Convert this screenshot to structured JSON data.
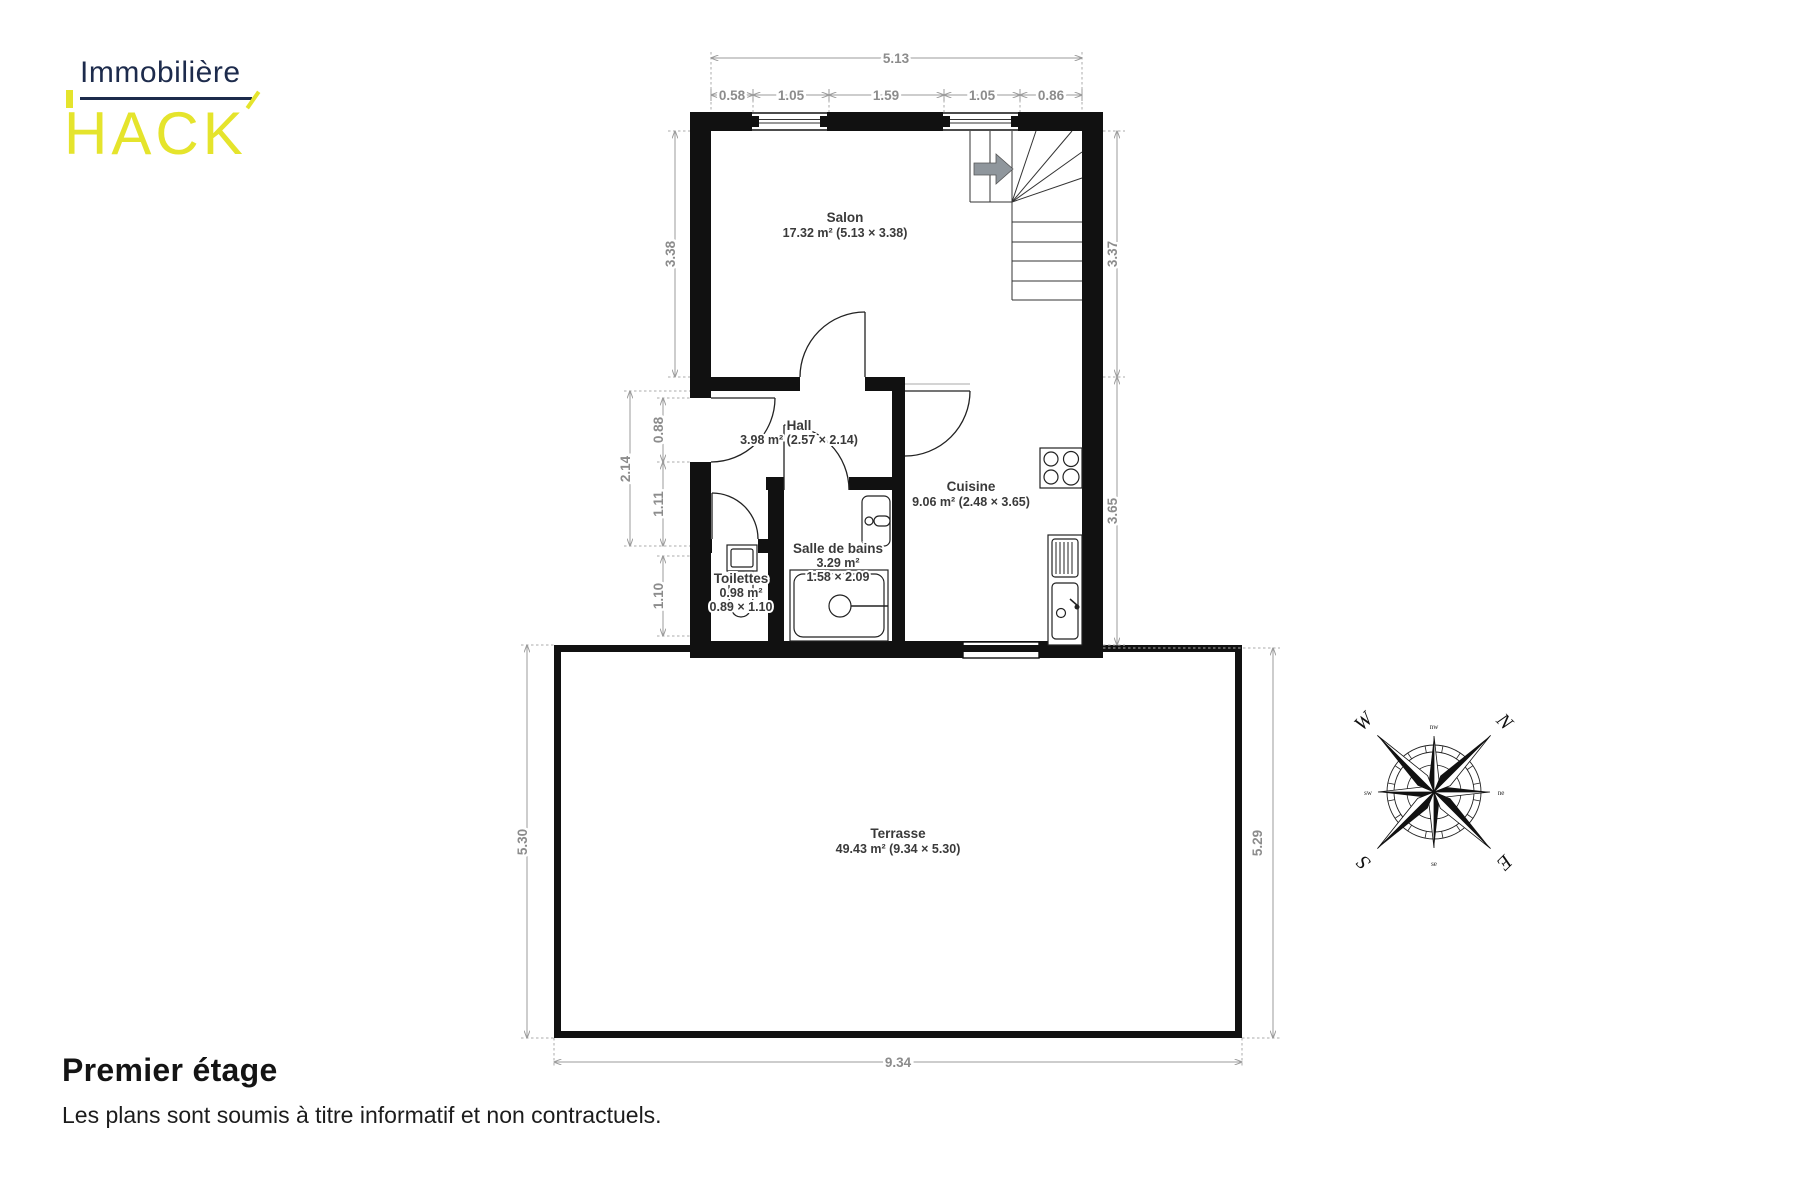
{
  "logo": {
    "line1": "Immobilière",
    "letters": [
      "H",
      "A",
      "C",
      "K"
    ],
    "navy": "#1d2b4c",
    "yellow": "#e5e42c"
  },
  "plan": {
    "rooms": [
      {
        "name": "Salon",
        "line2": "17.32 m² (5.13 × 3.38)"
      },
      {
        "name": "Hall",
        "line2": "3.98 m² (2.57 × 2.14)"
      },
      {
        "name": "Cuisine",
        "line2": "9.06 m² (2.48 × 3.65)"
      },
      {
        "name": "Salle de bains",
        "line2": "3.29 m²",
        "line3": "1.58 × 2.09"
      },
      {
        "name": "Toilettes",
        "line2": "0.98 m²",
        "line3": "0.89 × 1.10"
      },
      {
        "name": "Terrasse",
        "line2": "49.43 m² (9.34 × 5.30)"
      }
    ],
    "dims": {
      "top_total": "5.13",
      "top_segments": [
        "0.58",
        "1.05",
        "1.59",
        "1.05",
        "0.86"
      ],
      "salon_height": "3.38",
      "hall_height": "2.14",
      "hall_upper": "0.88",
      "hall_lower": "1.11",
      "toilettes_height": "1.10",
      "right_upper": "3.37",
      "right_lower": "3.65",
      "terrace_left": "5.30",
      "terrace_right": "5.29",
      "terrace_width": "9.34"
    }
  },
  "compass": {
    "n": "N",
    "e": "E",
    "s": "S",
    "w": "W",
    "ne": "ne",
    "se": "se",
    "sw": "sw",
    "nw": "nw"
  },
  "footer": {
    "title": "Premier étage",
    "subtitle": "Les plans sont soumis à titre informatif et non contractuels."
  }
}
